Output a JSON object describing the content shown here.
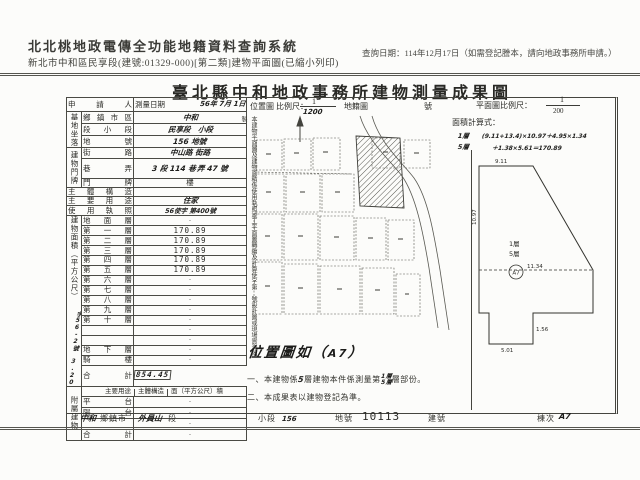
{
  "header": {
    "system_title": "北北桃地政電傳全功能地籍資料查詢系統",
    "system_subtitle": "新北市中和區民享段(建號:01329-000)[第二類]建物平面圖(已縮小列印)",
    "date_note": "查詢日期：114年12月17日（如需登記謄本，請向地政事務所申請。）"
  },
  "doc": {
    "title": "臺北縣中和地政事務所建物測量成果圖",
    "applicant_label": "申請人",
    "survey": {
      "label": "測量日期",
      "value": "56年 7月 1日"
    },
    "site": {
      "vlabel": "基地坐落",
      "rows": [
        {
          "label": "鄉鎮市區",
          "value": "中和"
        },
        {
          "label": "段小段",
          "value": "民享段　小段"
        },
        {
          "label": "地號",
          "value": "156 地號"
        }
      ]
    },
    "door": {
      "vlabel": "建物門牌",
      "rows": [
        {
          "label": "街路",
          "value": "中山路 街路"
        },
        {
          "label": "巷弄",
          "value": "3 段 114 巷",
          "value2": "弄 47 號"
        },
        {
          "label": "門牌",
          "value": "樓"
        }
      ]
    },
    "struct_row": {
      "label": "主體構造",
      "value": ""
    },
    "use_row": {
      "label": "主要用途",
      "value": "住家"
    },
    "license_row": {
      "label": "使用執照",
      "value": "56使字 第400號"
    },
    "area": {
      "vlabel": "建物面積（平方公尺）",
      "hand_note": "字56-2號 3.20",
      "floors": [
        {
          "label": "地面層",
          "value": "·"
        },
        {
          "label": "第一層",
          "value": "170.89"
        },
        {
          "label": "第二層",
          "value": "170.89"
        },
        {
          "label": "第三層",
          "value": "170.89"
        },
        {
          "label": "第四層",
          "value": "170.89"
        },
        {
          "label": "第五層",
          "value": "170.89"
        },
        {
          "label": "第六層",
          "value": "·"
        },
        {
          "label": "第七層",
          "value": "·"
        },
        {
          "label": "第八層",
          "value": "·"
        },
        {
          "label": "第九層",
          "value": "·"
        },
        {
          "label": "第十層",
          "value": "·"
        },
        {
          "label": "",
          "value": "·"
        },
        {
          "label": "",
          "value": "·"
        },
        {
          "label": "地下層",
          "value": "·"
        },
        {
          "label": "騎樓",
          "value": "·"
        },
        {
          "label": "合計",
          "value": "854.45"
        }
      ]
    },
    "annex": {
      "vlabel": "附屬建物",
      "headers": [
        "主要用途",
        "主體構造",
        "面（平方公尺）積"
      ],
      "rows": [
        {
          "label": "平台",
          "value": "·"
        },
        {
          "label": "陽台",
          "value": "·"
        },
        {
          "label": "",
          "value": "·"
        },
        {
          "label": "合計",
          "value": "·"
        }
      ]
    },
    "loc_scale": {
      "label": "位置圖",
      "scale": "比例尺：",
      "num": "1",
      "den": "1200",
      "map": "地籍圖",
      "no": "號"
    },
    "plan_scale": {
      "label": "平面圖比例尺：",
      "num": "1",
      "den": "200"
    },
    "calc": {
      "label": "面積計算式：",
      "fa": "1層",
      "fb": "5層",
      "line1": "(9.11+13.4)×10.97＋4.95×1.34",
      "line2": "＋1.38×5.61＝170.89"
    },
    "side_note": "本建物平面圖及建物面積係使用執照竣工平面圖轉繪及計算使字第　號設計圖或現場實測繪製",
    "loc_caption": {
      "p1": "位置圖如（",
      "hand": "A7",
      "p2": "）"
    },
    "notes": {
      "n1a": "一、本建物係",
      "n1h": "5",
      "n1b": "層建物本件係測量第",
      "n1f1": "1層",
      "n1f2": "5層",
      "n1c": "層部份。",
      "n2": "二、本成果表以建物登記為準。"
    },
    "plan": {
      "top": "9.11",
      "left": "10.97",
      "mid": "11.34",
      "notch": "1.56",
      "notch_b": "5.01",
      "fl1": "1層",
      "fl2": "5層",
      "mark": "A7"
    },
    "footer": {
      "i1_hand": "中和",
      "i1_label": "鄉鎮市",
      "i2_hand": "外員山",
      "i2_label": "段",
      "i3_label": "小段",
      "i3_hand": "156",
      "i4_label": "地號",
      "i4_value": "10113",
      "i5_label": "建號",
      "i6_label": "棟次",
      "i6_hand": "A7"
    }
  }
}
